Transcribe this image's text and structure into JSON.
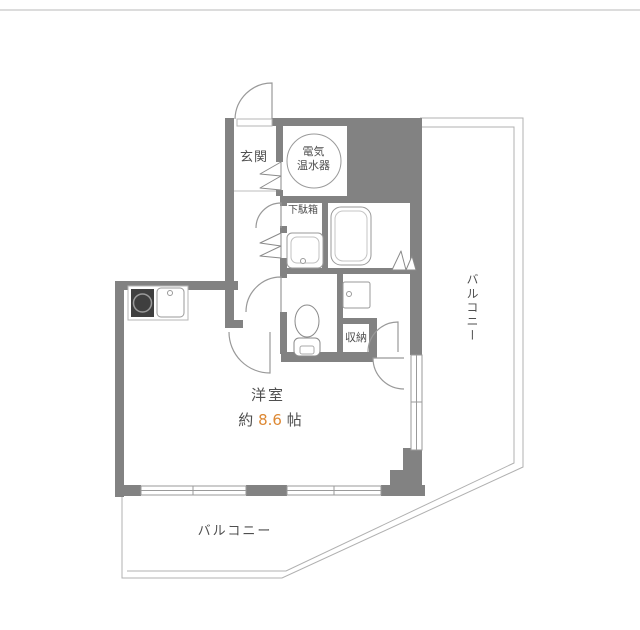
{
  "page": {
    "background": "#ffffff",
    "top_border_color": "#dcdcdc"
  },
  "floorplan": {
    "labels": {
      "genkan": "玄関",
      "water_heater_line1": "電気",
      "water_heater_line2": "温水器",
      "shoe_cabinet": "下駄箱",
      "storage": "収納",
      "main_room": "洋室",
      "main_room_size_prefix": "約",
      "main_room_size_value": "8.6",
      "main_room_size_unit": "帖",
      "balcony_right": "バルコニー",
      "balcony_bottom": "バルコニー"
    },
    "colors": {
      "wall": "#828282",
      "thin_line": "#a8a8a8",
      "door_line": "#999999",
      "text": "#4f4f4f",
      "size_accent": "#dd8833",
      "stove_fill": "#3f3f3f"
    }
  }
}
